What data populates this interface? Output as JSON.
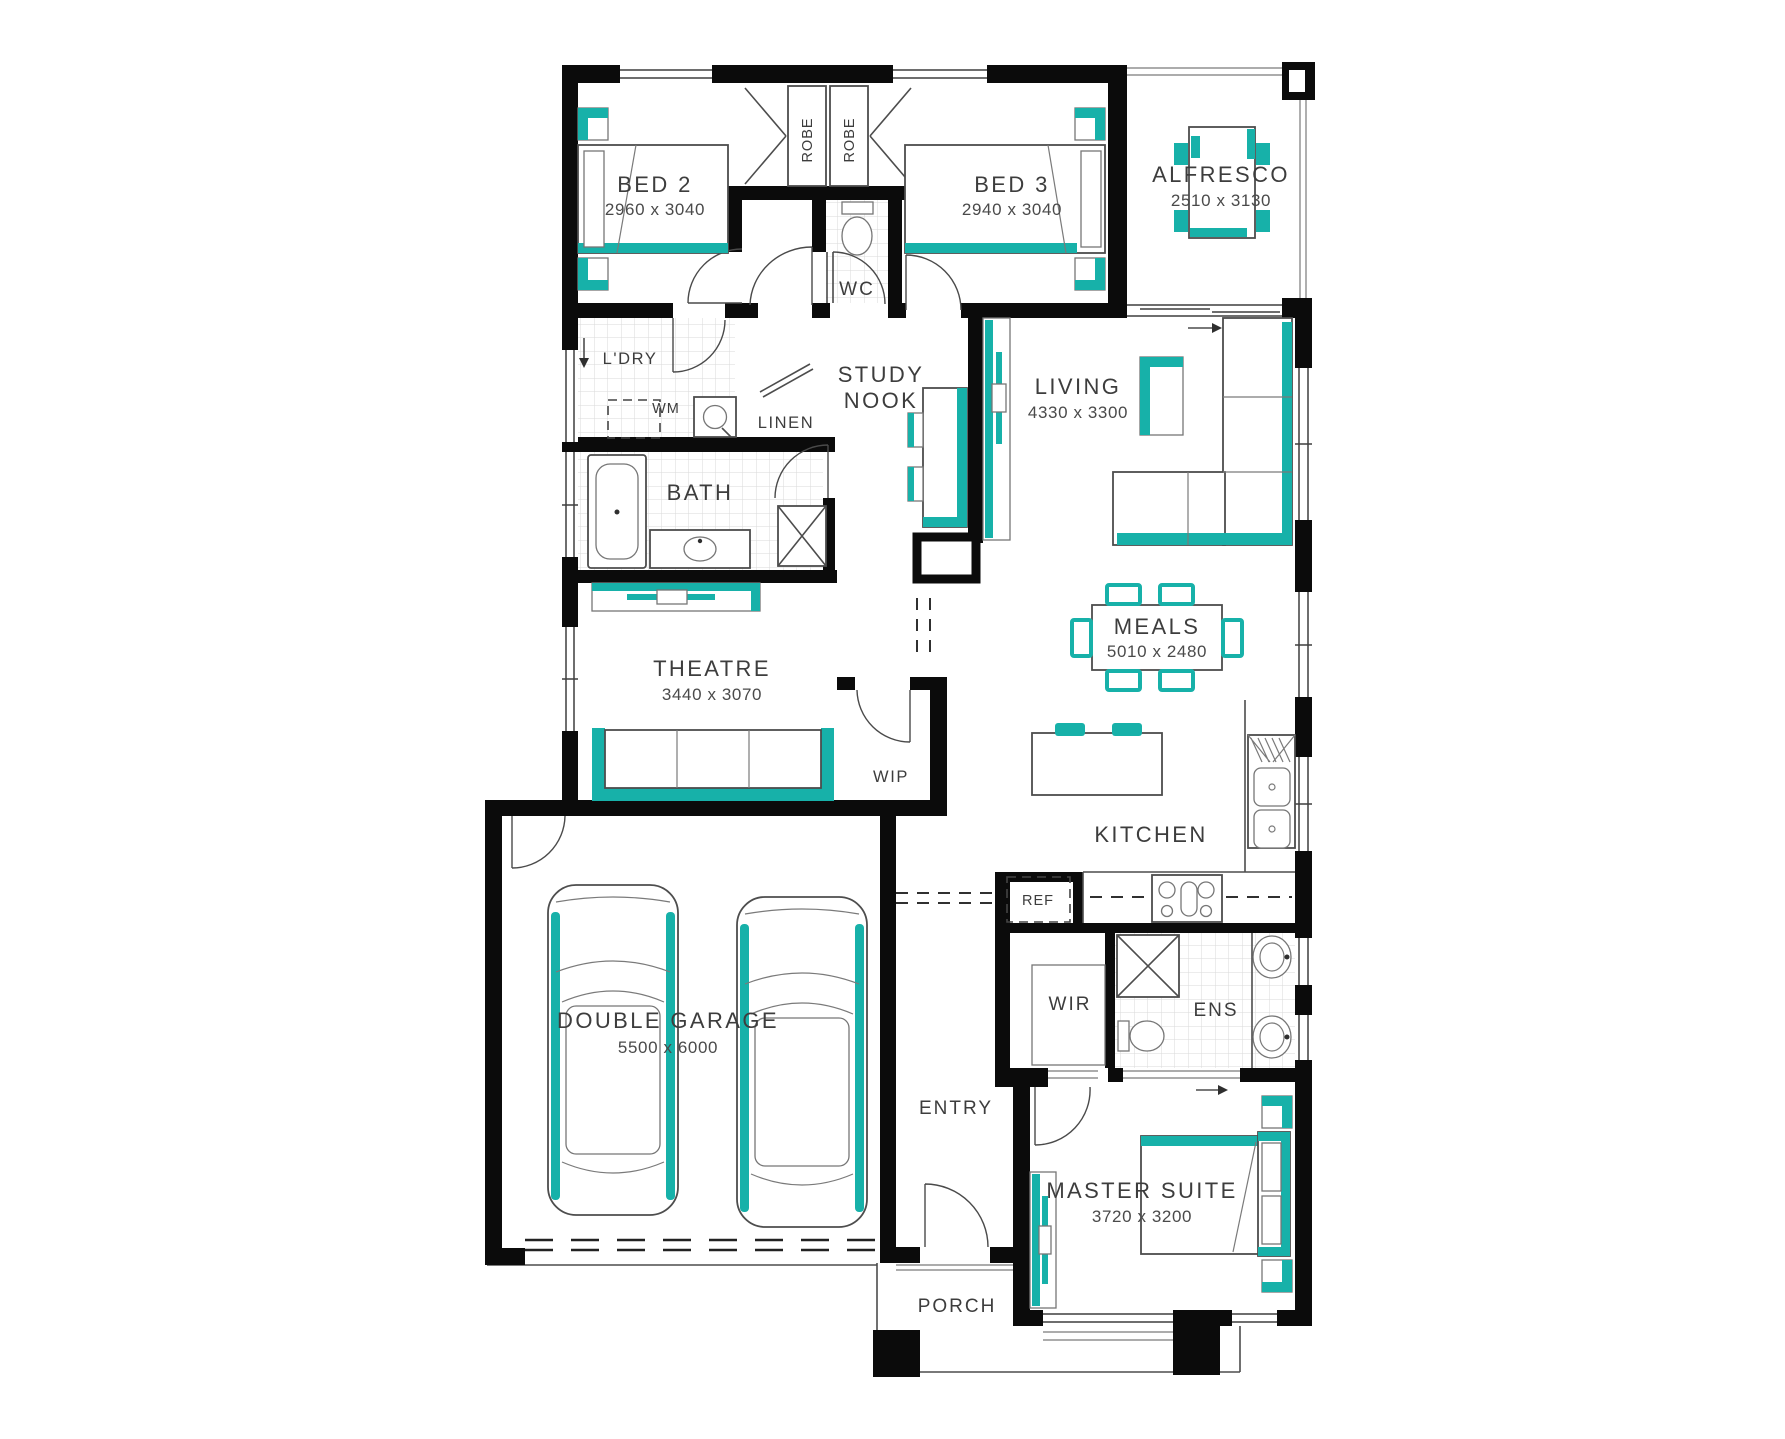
{
  "colors": {
    "accent": "#17B1A9",
    "wall": "#0B0B0B",
    "text": "#3D3D3D"
  },
  "rooms": {
    "bed2": {
      "name": "BED 2",
      "dims": "2960 x 3040"
    },
    "bed3": {
      "name": "BED 3",
      "dims": "2940 x 3040"
    },
    "alfresco": {
      "name": "ALFRESCO",
      "dims": "2510 x 3130"
    },
    "living": {
      "name": "LIVING",
      "dims": "4330 x 3300"
    },
    "meals": {
      "name": "MEALS",
      "dims": "5010 x 2480"
    },
    "theatre": {
      "name": "THEATRE",
      "dims": "3440 x 3070"
    },
    "garage": {
      "name": "DOUBLE GARAGE",
      "dims": "5500 x 6000"
    },
    "master": {
      "name": "MASTER SUITE",
      "dims": "3720 x 3200"
    },
    "study": {
      "line1": "STUDY",
      "line2": "NOOK"
    },
    "kitchen": {
      "name": "KITCHEN"
    },
    "wip": {
      "name": "WIP"
    },
    "wc": {
      "name": "WC"
    },
    "ldry": {
      "name": "L'DRY"
    },
    "wm": {
      "name": "WM"
    },
    "linen": {
      "name": "LINEN"
    },
    "bath": {
      "name": "BATH"
    },
    "ref": {
      "name": "REF"
    },
    "wir": {
      "name": "WIR"
    },
    "ens": {
      "name": "ENS"
    },
    "entry": {
      "name": "ENTRY"
    },
    "porch": {
      "name": "PORCH"
    },
    "robe": {
      "name": "ROBE"
    }
  }
}
